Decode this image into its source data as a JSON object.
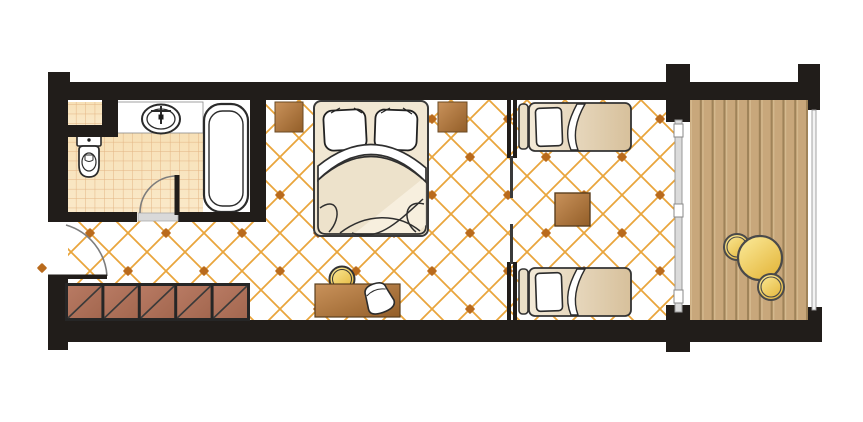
{
  "colors": {
    "white": "#FFFFFF",
    "wall": "#211D1A",
    "lattice_line": "#E9A53C",
    "lattice_dot": "#B96A1C",
    "tile_base": "#F7E0B6",
    "tile_line": "#E3B483",
    "deck_base": "#C8A77B",
    "deck_line": "#9F8359",
    "wood_light": "#C9925B",
    "wood_dark": "#935E28",
    "wardrobe_light": "#B87A63",
    "wardrobe_dark": "#A3674F",
    "bed_cream": "#F1E7D3",
    "duvet": "#EDE2CB",
    "duvet_sheen": "#F8F1E2",
    "bed_grad_light": "#F3EAD8",
    "bed_grad_dark": "#D7C09B",
    "headboard": "#EADFC7",
    "gold_light": "#FCEC9C",
    "gold_dark": "#E4B63C",
    "glass": "#DBDBDB",
    "threshold": "#D9D9D9",
    "arc_gray": "#7D7D7D"
  },
  "floor_plan": {
    "rooms": [
      {
        "id": "bathroom",
        "fixtures": [
          "wall-niche",
          "washbasin-counter",
          "washbasin",
          "bathtub",
          "toilet",
          "bathroom-door",
          "tiled-floor"
        ]
      },
      {
        "id": "entrance-hall",
        "fixtures": [
          "entrance-door",
          "wardrobe-5-sections",
          "lattice-floor"
        ]
      },
      {
        "id": "bedroom",
        "fixtures": [
          "double-bed",
          "pillow-left",
          "pillow-right",
          "nightstand-left",
          "nightstand-right",
          "desk",
          "desk-chair",
          "stool"
        ]
      },
      {
        "id": "twin-room",
        "fixtures": [
          "sliding-partition",
          "twin-bed-top",
          "twin-bed-bottom",
          "side-table"
        ]
      },
      {
        "id": "balcony",
        "fixtures": [
          "sliding-glass-door",
          "wood-deck",
          "round-table",
          "balcony-stool-1",
          "balcony-stool-2",
          "railing"
        ]
      }
    ]
  }
}
